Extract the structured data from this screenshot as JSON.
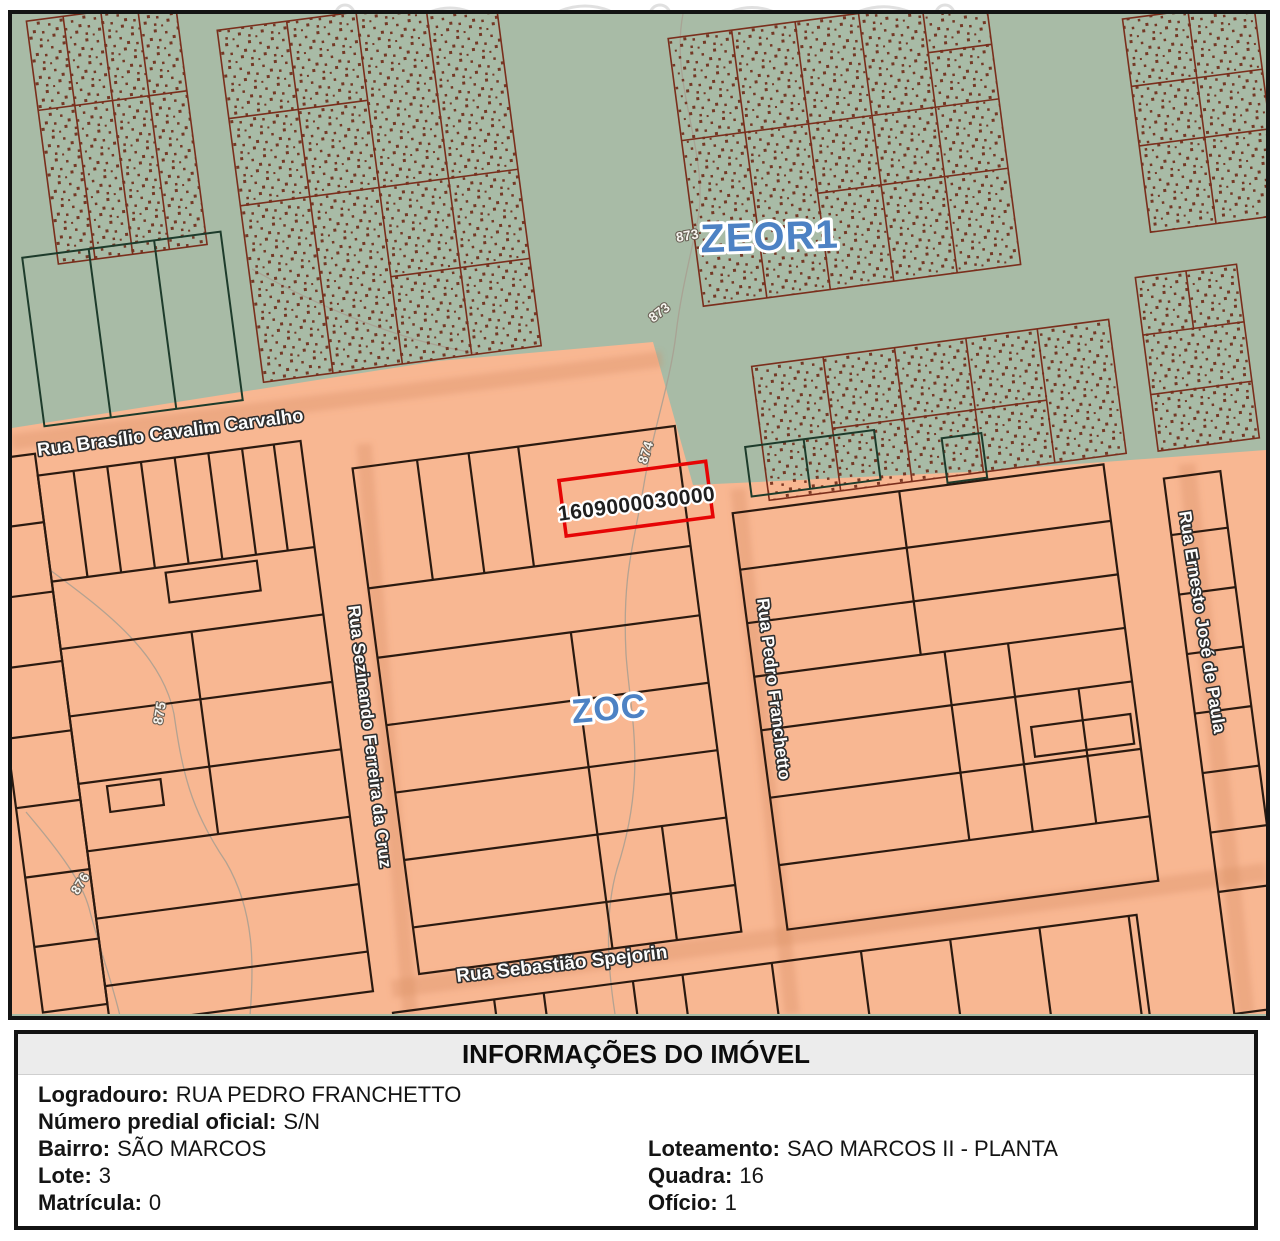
{
  "map": {
    "zone_labels": [
      {
        "text": "ZEOR1"
      },
      {
        "text": "ZOC"
      }
    ],
    "parcel_id": "1609000030000",
    "streets": [
      "Rua Brasílio Cavalim Carvalho",
      "Rua Sezinando Ferreira da Cruz",
      "Rua Pedro Franchetto",
      "Rua Ernesto José de Paula",
      "Rua Sebastião Spejorin"
    ],
    "contour_labels": [
      "873",
      "873",
      "874",
      "875",
      "876"
    ],
    "colors": {
      "zone_zeor1_fill": "#a8bba6",
      "zone_zoc_fill": "#f8b792",
      "highlight_parcel_stroke": "#e60505",
      "zone_label_text": "#4d82c4",
      "green_parcel_stroke": "#7a2e1c",
      "orange_parcel_stroke": "#2b1a10"
    }
  },
  "info_panel": {
    "title": "INFORMAÇÕES DO IMÓVEL",
    "fields": {
      "logradouro": {
        "label": "Logradouro:",
        "value": "RUA PEDRO FRANCHETTO"
      },
      "numero_predial": {
        "label": "Número predial oficial:",
        "value": "S/N"
      },
      "bairro": {
        "label": "Bairro:",
        "value": "SÃO MARCOS"
      },
      "lote": {
        "label": "Lote:",
        "value": "3"
      },
      "matricula": {
        "label": "Matrícula:",
        "value": "0"
      },
      "loteamento": {
        "label": "Loteamento:",
        "value": "SAO MARCOS II - PLANTA"
      },
      "quadra": {
        "label": "Quadra:",
        "value": "16"
      },
      "oficio": {
        "label": "Ofício:",
        "value": "1"
      }
    }
  }
}
